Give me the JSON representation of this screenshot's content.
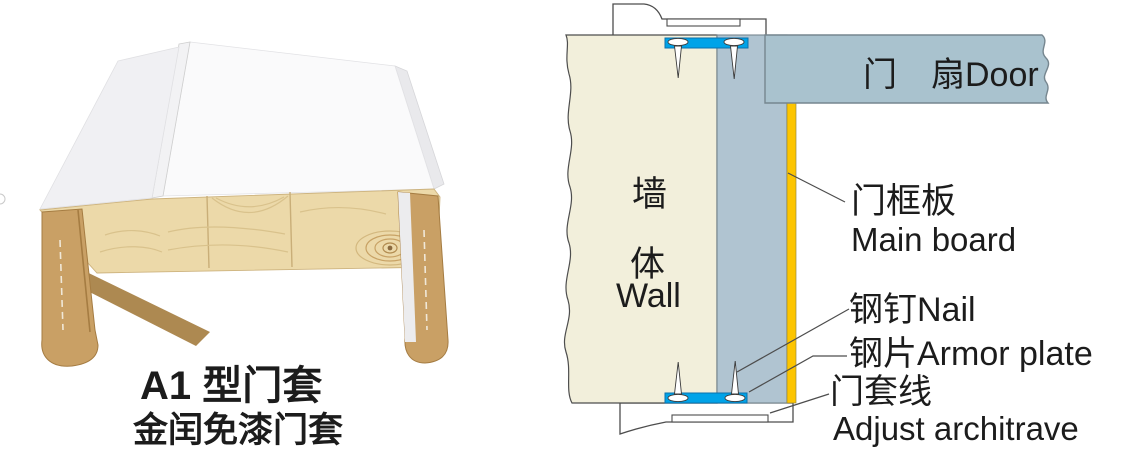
{
  "product": {
    "caption_line1": "A1 型门套",
    "caption_line2": "金闰免漆门套"
  },
  "diagram": {
    "wall_label_cn_1": "墙",
    "wall_label_cn_2": "体",
    "wall_label_en": "Wall",
    "door_label": "门　扇Door",
    "main_board_label_cn": "门框板",
    "main_board_label_en": "Main board",
    "nail_label": "钢钉Nail",
    "armor_plate_label": "钢片Armor plate",
    "architrave_label_cn": "门套线",
    "architrave_label_en": "Adjust architrave",
    "colors": {
      "wall": "#f2efdb",
      "frame_board": "#b0c4d1",
      "door_leaf": "#a9c2ce",
      "armor_plate": "#00a3e8",
      "edge_strip": "#fdc500"
    }
  },
  "photo_colors": {
    "surface_white": "#fafafb",
    "wood_face": "#ecd9a9",
    "wood_leg": "#c9a065"
  }
}
